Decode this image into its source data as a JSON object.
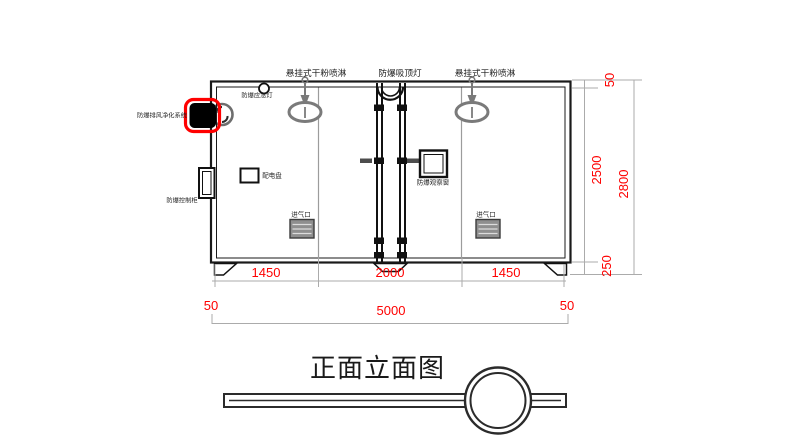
{
  "title": "正面立面图",
  "equipment_labels": {
    "sprinkler_left": "悬挂式干粉喷淋",
    "ceiling_lamp": "防爆吸顶灯",
    "sprinkler_right": "悬挂式干粉喷淋",
    "emergency_lamp": "防爆应急灯",
    "exhaust_system": "防爆排风净化系统",
    "control_cabinet": "防爆控制柜",
    "distribution_panel": "配电盘",
    "observation_window": "防爆观察窗",
    "air_inlet_left": "进气口",
    "air_inlet_right": "进气口"
  },
  "dimensions": {
    "horizontal_segments": [
      "1450",
      "2000",
      "1450"
    ],
    "horizontal_offsets": [
      "50",
      "50"
    ],
    "horizontal_total": "5000",
    "vertical": {
      "top_offset": "50",
      "body": "2500",
      "base": "250",
      "total": "2800"
    }
  },
  "colors": {
    "dimension_text": "#fe0000",
    "highlight_box": "#ff0000",
    "drawing_line": "#1a1a1a",
    "fixture_gray": "#7a7a7a"
  }
}
